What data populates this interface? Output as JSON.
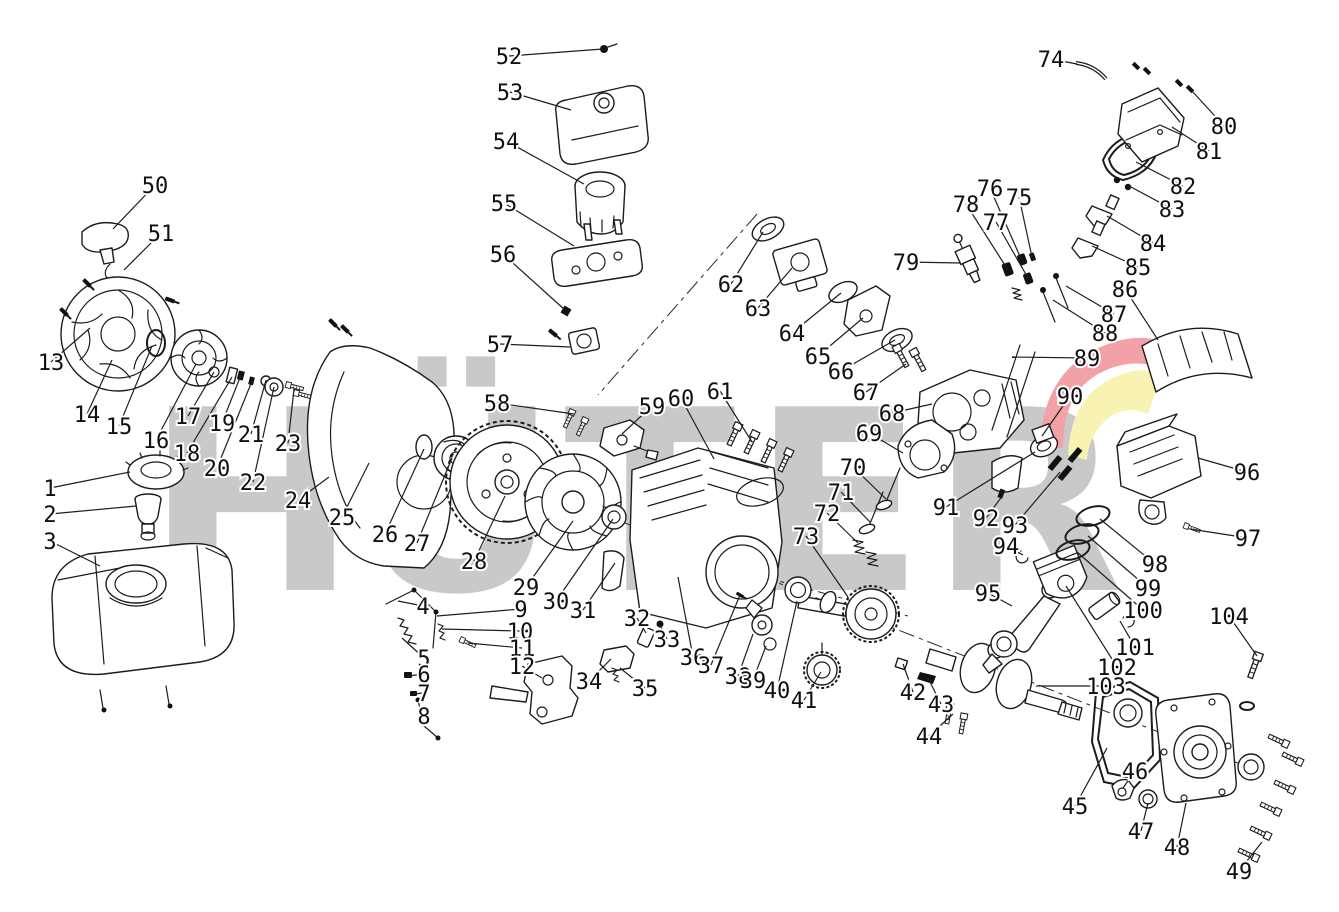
{
  "diagram": {
    "type": "exploded-parts-diagram",
    "subject": "engine-spare-parts",
    "background_color": "#ffffff",
    "line_color": "#1c1c1c",
    "label_color": "#101010",
    "watermark": {
      "text": "HÜTER",
      "letters": [
        "H",
        "Ü",
        "T",
        "E",
        "R"
      ],
      "color": "#c9c9c9",
      "swoosh_red": "#f2a2a6",
      "swoosh_yellow": "#f8f3b2"
    },
    "labels": [
      {
        "n": "1",
        "x": 50,
        "y": 488,
        "tx": 130,
        "ty": 472
      },
      {
        "n": "2",
        "x": 50,
        "y": 514,
        "tx": 136,
        "ty": 506
      },
      {
        "n": "3",
        "x": 50,
        "y": 541,
        "tx": 100,
        "ty": 566
      },
      {
        "n": "4",
        "x": 423,
        "y": 606,
        "tx": 398,
        "ty": 601
      },
      {
        "n": "5",
        "x": 424,
        "y": 658,
        "tx": 402,
        "ty": 638
      },
      {
        "n": "6",
        "x": 424,
        "y": 674,
        "tx": 408,
        "ty": 676
      },
      {
        "n": "7",
        "x": 424,
        "y": 693,
        "tx": 413,
        "ty": 694
      },
      {
        "n": "8",
        "x": 424,
        "y": 716,
        "tx": 420,
        "ty": 716
      },
      {
        "n": "9",
        "x": 521,
        "y": 609,
        "tx": 437,
        "ty": 616
      },
      {
        "n": "10",
        "x": 520,
        "y": 631,
        "tx": 442,
        "ty": 629
      },
      {
        "n": "11",
        "x": 522,
        "y": 648,
        "tx": 468,
        "ty": 643
      },
      {
        "n": "12",
        "x": 522,
        "y": 666,
        "tx": 542,
        "ty": 678
      },
      {
        "n": "13",
        "x": 51,
        "y": 362,
        "tx": 90,
        "ty": 328
      },
      {
        "n": "14",
        "x": 87,
        "y": 414,
        "tx": 112,
        "ty": 360
      },
      {
        "n": "15",
        "x": 119,
        "y": 426,
        "tx": 152,
        "ty": 346
      },
      {
        "n": "16",
        "x": 156,
        "y": 440,
        "tx": 196,
        "ty": 364
      },
      {
        "n": "17",
        "x": 188,
        "y": 416,
        "tx": 214,
        "ty": 372
      },
      {
        "n": "18",
        "x": 187,
        "y": 453,
        "tx": 232,
        "ty": 377
      },
      {
        "n": "19",
        "x": 222,
        "y": 423,
        "tx": 241,
        "ty": 375
      },
      {
        "n": "20",
        "x": 217,
        "y": 468,
        "tx": 252,
        "ty": 381
      },
      {
        "n": "21",
        "x": 251,
        "y": 434,
        "tx": 266,
        "ty": 380
      },
      {
        "n": "22",
        "x": 253,
        "y": 482,
        "tx": 274,
        "ty": 387
      },
      {
        "n": "23",
        "x": 288,
        "y": 443,
        "tx": 294,
        "ty": 389
      },
      {
        "n": "24",
        "x": 298,
        "y": 500,
        "tx": 329,
        "ty": 477
      },
      {
        "n": "25",
        "x": 342,
        "y": 517,
        "tx": 369,
        "ty": 463
      },
      {
        "n": "26",
        "x": 385,
        "y": 534,
        "tx": 424,
        "ty": 449
      },
      {
        "n": "27",
        "x": 417,
        "y": 543,
        "tx": 452,
        "ty": 458
      },
      {
        "n": "28",
        "x": 474,
        "y": 561,
        "tx": 505,
        "ty": 496
      },
      {
        "n": "29",
        "x": 526,
        "y": 587,
        "tx": 573,
        "ty": 521
      },
      {
        "n": "30",
        "x": 556,
        "y": 601,
        "tx": 613,
        "ty": 519
      },
      {
        "n": "31",
        "x": 583,
        "y": 610,
        "tx": 615,
        "ty": 563
      },
      {
        "n": "32",
        "x": 637,
        "y": 618,
        "tx": 646,
        "ty": 633
      },
      {
        "n": "33",
        "x": 667,
        "y": 639,
        "tx": 660,
        "ty": 625
      },
      {
        "n": "34",
        "x": 589,
        "y": 681,
        "tx": 611,
        "ty": 659
      },
      {
        "n": "35",
        "x": 645,
        "y": 688,
        "tx": 620,
        "ty": 668
      },
      {
        "n": "36",
        "x": 693,
        "y": 657,
        "tx": 678,
        "ty": 577
      },
      {
        "n": "37",
        "x": 711,
        "y": 665,
        "tx": 740,
        "ty": 595
      },
      {
        "n": "38",
        "x": 738,
        "y": 676,
        "tx": 753,
        "ty": 634
      },
      {
        "n": "39",
        "x": 753,
        "y": 680,
        "tx": 766,
        "ty": 646
      },
      {
        "n": "40",
        "x": 777,
        "y": 690,
        "tx": 797,
        "ty": 601
      },
      {
        "n": "41",
        "x": 804,
        "y": 700,
        "tx": 821,
        "ty": 672
      },
      {
        "n": "42",
        "x": 913,
        "y": 692,
        "tx": 903,
        "ty": 664
      },
      {
        "n": "43",
        "x": 941,
        "y": 704,
        "tx": 928,
        "ty": 678
      },
      {
        "n": "44",
        "x": 929,
        "y": 736,
        "tx": 953,
        "ty": 714
      },
      {
        "n": "45",
        "x": 1075,
        "y": 806,
        "tx": 1107,
        "ty": 748
      },
      {
        "n": "46",
        "x": 1135,
        "y": 771,
        "tx": 1123,
        "ty": 788
      },
      {
        "n": "47",
        "x": 1141,
        "y": 831,
        "tx": 1148,
        "ty": 803
      },
      {
        "n": "48",
        "x": 1177,
        "y": 847,
        "tx": 1186,
        "ty": 803
      },
      {
        "n": "49",
        "x": 1239,
        "y": 871,
        "tx": 1262,
        "ty": 842
      },
      {
        "n": "50",
        "x": 155,
        "y": 185,
        "tx": 113,
        "ty": 229
      },
      {
        "n": "51",
        "x": 161,
        "y": 233,
        "tx": 124,
        "ty": 270
      },
      {
        "n": "52",
        "x": 509,
        "y": 56,
        "tx": 603,
        "ty": 49
      },
      {
        "n": "53",
        "x": 510,
        "y": 92,
        "tx": 571,
        "ty": 110
      },
      {
        "n": "54",
        "x": 506,
        "y": 141,
        "tx": 584,
        "ty": 184
      },
      {
        "n": "55",
        "x": 504,
        "y": 203,
        "tx": 574,
        "ty": 246
      },
      {
        "n": "56",
        "x": 503,
        "y": 254,
        "tx": 565,
        "ty": 310
      },
      {
        "n": "57",
        "x": 500,
        "y": 344,
        "tx": 570,
        "ty": 347
      },
      {
        "n": "58",
        "x": 497,
        "y": 403,
        "tx": 574,
        "ty": 414
      },
      {
        "n": "59",
        "x": 652,
        "y": 406,
        "tx": 622,
        "ty": 434
      },
      {
        "n": "60",
        "x": 681,
        "y": 398,
        "tx": 714,
        "ty": 459
      },
      {
        "n": "61",
        "x": 720,
        "y": 391,
        "tx": 752,
        "ty": 442
      },
      {
        "n": "62",
        "x": 731,
        "y": 284,
        "tx": 763,
        "ty": 232
      },
      {
        "n": "63",
        "x": 758,
        "y": 308,
        "tx": 792,
        "ty": 268
      },
      {
        "n": "64",
        "x": 792,
        "y": 333,
        "tx": 841,
        "ty": 293
      },
      {
        "n": "65",
        "x": 818,
        "y": 356,
        "tx": 863,
        "ty": 318
      },
      {
        "n": "66",
        "x": 841,
        "y": 371,
        "tx": 895,
        "ty": 340
      },
      {
        "n": "67",
        "x": 866,
        "y": 392,
        "tx": 906,
        "ty": 364
      },
      {
        "n": "68",
        "x": 892,
        "y": 413,
        "tx": 932,
        "ty": 404
      },
      {
        "n": "69",
        "x": 869,
        "y": 433,
        "tx": 903,
        "ty": 453
      },
      {
        "n": "70",
        "x": 853,
        "y": 467,
        "tx": 886,
        "ty": 499
      },
      {
        "n": "71",
        "x": 841,
        "y": 492,
        "tx": 870,
        "ty": 522
      },
      {
        "n": "72",
        "x": 827,
        "y": 513,
        "tx": 858,
        "ty": 543
      },
      {
        "n": "73",
        "x": 806,
        "y": 536,
        "tx": 848,
        "ty": 597
      },
      {
        "n": "74",
        "x": 1051,
        "y": 59,
        "tx": 1077,
        "ty": 64
      },
      {
        "n": "75",
        "x": 1019,
        "y": 197,
        "tx": 1032,
        "ty": 257
      },
      {
        "n": "76",
        "x": 990,
        "y": 188,
        "tx": 1022,
        "ty": 261
      },
      {
        "n": "77",
        "x": 996,
        "y": 222,
        "tx": 1028,
        "ty": 278
      },
      {
        "n": "78",
        "x": 966,
        "y": 204,
        "tx": 1008,
        "ty": 270
      },
      {
        "n": "79",
        "x": 906,
        "y": 262,
        "tx": 961,
        "ty": 263
      },
      {
        "n": "80",
        "x": 1224,
        "y": 126,
        "tx": 1192,
        "ty": 91
      },
      {
        "n": "81",
        "x": 1209,
        "y": 151,
        "tx": 1172,
        "ty": 127
      },
      {
        "n": "82",
        "x": 1183,
        "y": 186,
        "tx": 1136,
        "ty": 162
      },
      {
        "n": "83",
        "x": 1172,
        "y": 209,
        "tx": 1131,
        "ty": 187
      },
      {
        "n": "84",
        "x": 1153,
        "y": 243,
        "tx": 1107,
        "ty": 216
      },
      {
        "n": "85",
        "x": 1138,
        "y": 267,
        "tx": 1092,
        "ty": 246
      },
      {
        "n": "86",
        "x": 1125,
        "y": 289,
        "tx": 1158,
        "ty": 340
      },
      {
        "n": "87",
        "x": 1114,
        "y": 314,
        "tx": 1066,
        "ty": 286
      },
      {
        "n": "88",
        "x": 1105,
        "y": 333,
        "tx": 1053,
        "ty": 300
      },
      {
        "n": "89",
        "x": 1087,
        "y": 358,
        "tx": 1012,
        "ty": 357
      },
      {
        "n": "90",
        "x": 1070,
        "y": 396,
        "tx": 1042,
        "ty": 436
      },
      {
        "n": "91",
        "x": 946,
        "y": 507,
        "tx": 1035,
        "ty": 452
      },
      {
        "n": "92",
        "x": 986,
        "y": 518,
        "tx": 1003,
        "ty": 495
      },
      {
        "n": "93",
        "x": 1015,
        "y": 525,
        "tx": 1060,
        "ty": 472
      },
      {
        "n": "94",
        "x": 1006,
        "y": 546,
        "tx": 1023,
        "ty": 555
      },
      {
        "n": "95",
        "x": 988,
        "y": 593,
        "tx": 1012,
        "ty": 606
      },
      {
        "n": "96",
        "x": 1247,
        "y": 472,
        "tx": 1198,
        "ty": 458
      },
      {
        "n": "97",
        "x": 1248,
        "y": 538,
        "tx": 1190,
        "ty": 529
      },
      {
        "n": "98",
        "x": 1155,
        "y": 564,
        "tx": 1100,
        "ty": 519
      },
      {
        "n": "99",
        "x": 1148,
        "y": 588,
        "tx": 1088,
        "ty": 536
      },
      {
        "n": "100",
        "x": 1143,
        "y": 610,
        "tx": 1077,
        "ty": 552
      },
      {
        "n": "101",
        "x": 1135,
        "y": 647,
        "tx": 1120,
        "ty": 621
      },
      {
        "n": "102",
        "x": 1117,
        "y": 667,
        "tx": 1066,
        "ty": 586
      },
      {
        "n": "103",
        "x": 1106,
        "y": 686,
        "tx": 1036,
        "ty": 686
      },
      {
        "n": "104",
        "x": 1229,
        "y": 616,
        "tx": 1257,
        "ty": 656
      }
    ]
  }
}
